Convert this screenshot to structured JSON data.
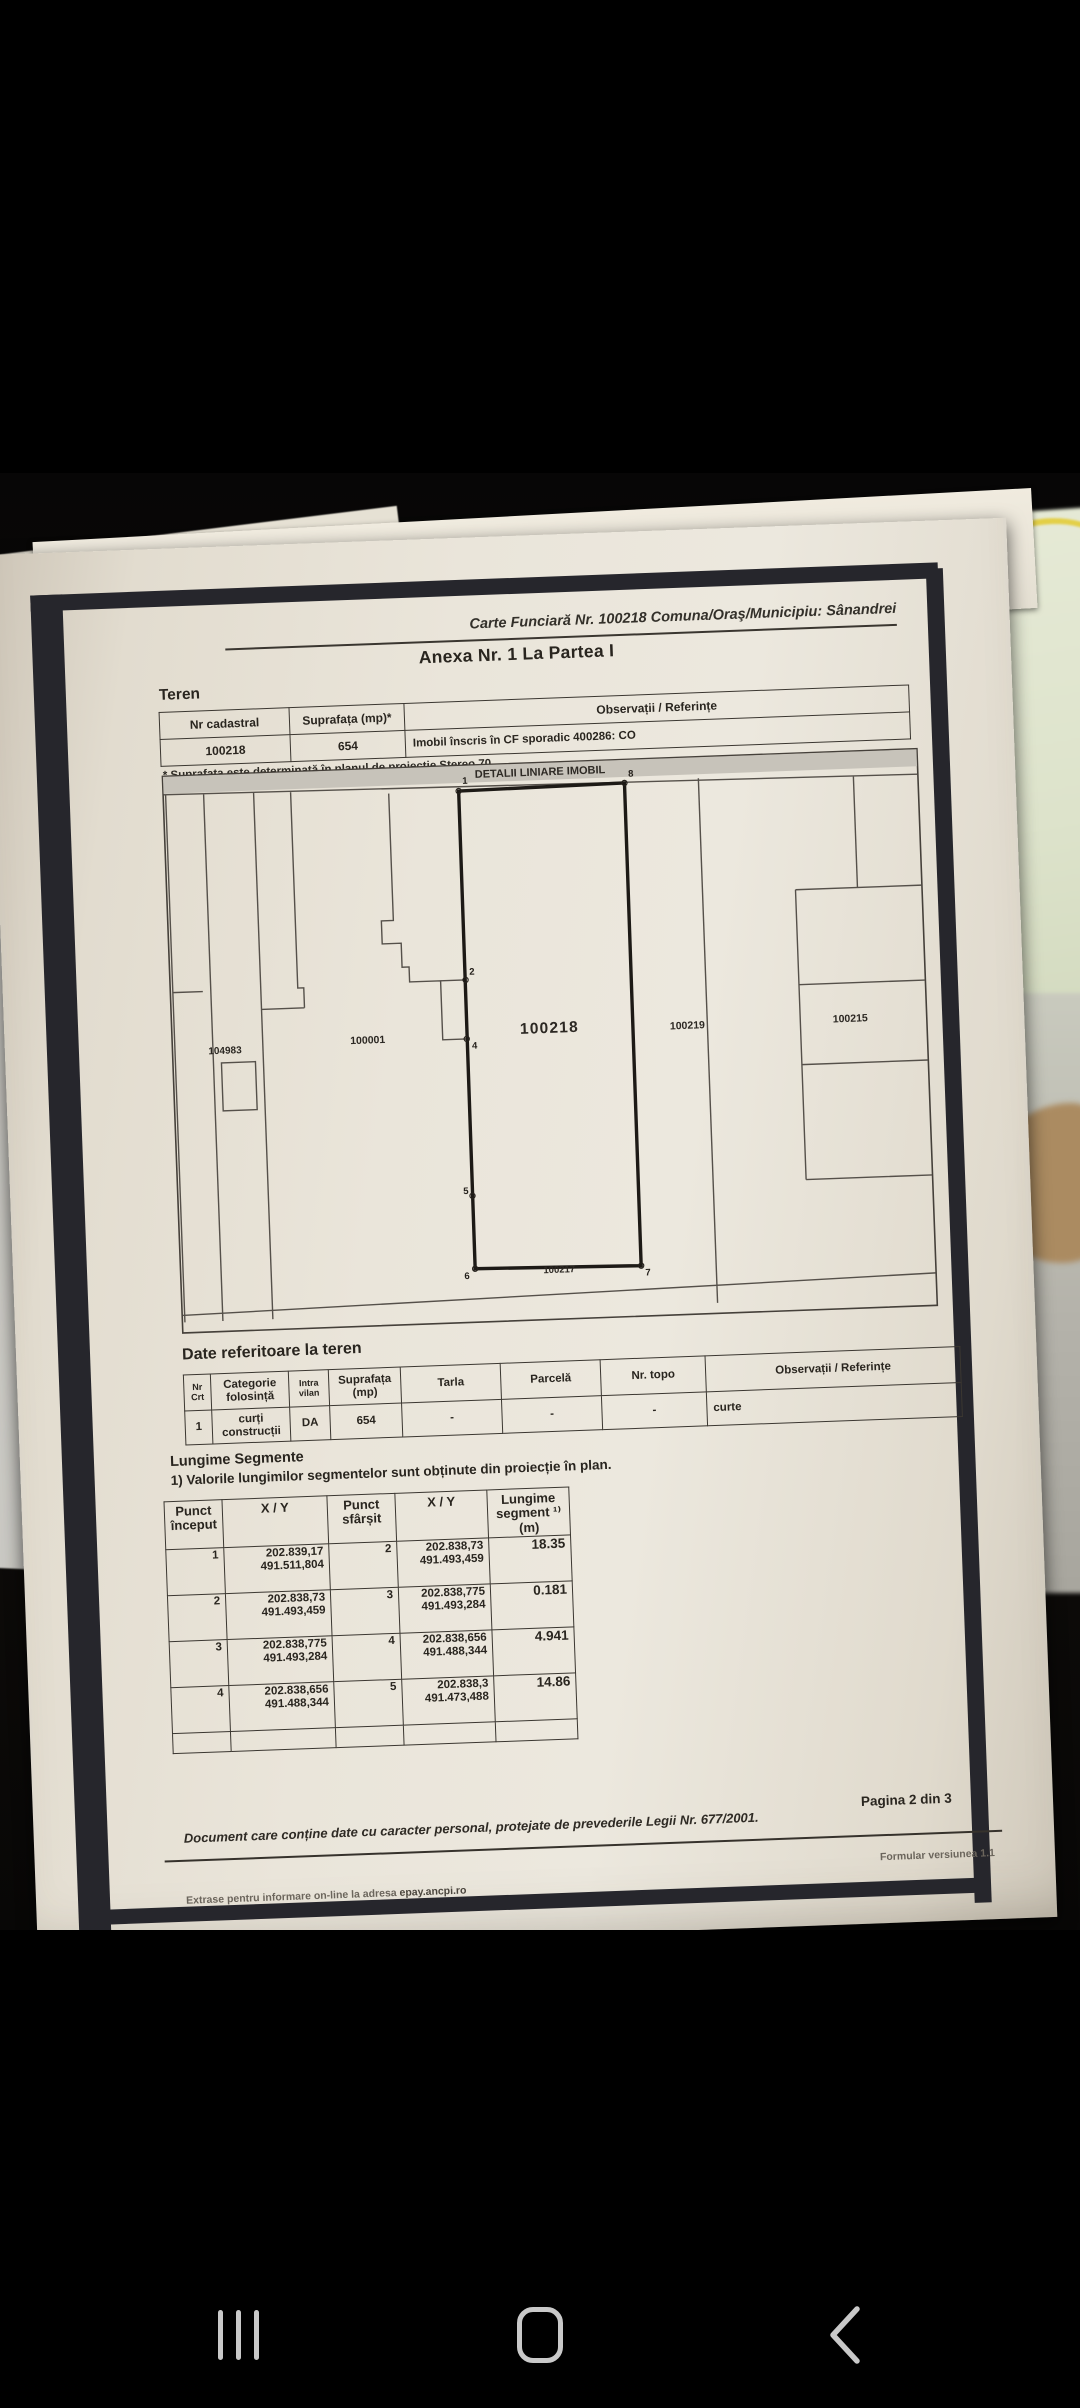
{
  "colors": {
    "paper": "#eae5da",
    "scan_border": "#26262c",
    "ink": "#29251f",
    "background_green": "#dde3cb",
    "background_yellow": "#e3cf46",
    "nav_icon": "#c9c9c9"
  },
  "nav": {
    "recents_icon": "recents-bars",
    "home_icon": "home-outline",
    "back_icon": "back-chevron"
  },
  "doc": {
    "ref_line": "Carte Funciară Nr. 100218 Comuna/Oraş/Municipiu: Sânandrei",
    "anexa_title": "Anexa Nr. 1 La Partea I",
    "teren_heading": "Teren",
    "teren_table": {
      "h_nr_cadastral": "Nr cadastral",
      "h_suprafata": "Suprafața (mp)*",
      "h_observatii": "Observații / Referințe",
      "nr_cadastral": "100218",
      "suprafata": "654",
      "observatii": "Imobil înscris în CF sporadic 400286: CO"
    },
    "footnote": "* Suprafața este determinată în planul de proiecție Stereo 70.",
    "plan": {
      "title": "DETALII LINIARE IMOBIL",
      "parcel_104983": "104983",
      "parcel_100001": "100001",
      "parcel_100218": "100218",
      "parcel_100219": "100219",
      "parcel_100215": "100215",
      "road_label": "100217",
      "pt1": "1",
      "pt2": "2",
      "pt4": "4",
      "pt5": "5",
      "pt6": "6",
      "pt7": "7",
      "pt8": "8"
    },
    "date_teren": {
      "heading": "Date referitoare la teren",
      "h_nr": "Nr Crt",
      "h_categorie": "Categorie folosință",
      "h_intravilan": "Intra vilan",
      "h_suprafata": "Suprafața (mp)",
      "h_tarla": "Tarla",
      "h_parcela": "Parcelă",
      "h_nrtopo": "Nr. topo",
      "h_obs": "Observații / Referințe",
      "r_nr": "1",
      "r_categorie": "curți construcții",
      "r_intravilan": "DA",
      "r_suprafata": "654",
      "r_tarla": "-",
      "r_parcela": "-",
      "r_nrtopo": "-",
      "r_obs": "curte"
    },
    "segments": {
      "heading": "Lungime Segmente",
      "note": "1) Valorile lungimilor segmentelor sunt obținute din proiecție în plan.",
      "h_p_start": "Punct început",
      "h_xy1": "X / Y",
      "h_p_end": "Punct sfârșit",
      "h_xy2": "X / Y",
      "h_len": "Lungime segment ¹⁾ (m)",
      "rows": [
        {
          "p1": "1",
          "x1": "202.839,17",
          "y1": "491.511,804",
          "p2": "2",
          "x2": "202.838,73",
          "y2": "491.493,459",
          "len": "18.35"
        },
        {
          "p1": "2",
          "x1": "202.838,73",
          "y1": "491.493,459",
          "p2": "3",
          "x2": "202.838,775",
          "y2": "491.493,284",
          "len": "0.181"
        },
        {
          "p1": "3",
          "x1": "202.838,775",
          "y1": "491.493,284",
          "p2": "4",
          "x2": "202.838,656",
          "y2": "491.488,344",
          "len": "4.941"
        },
        {
          "p1": "4",
          "x1": "202.838,656",
          "y1": "491.488,344",
          "p2": "5",
          "x2": "202.838,3",
          "y2": "491.473,488",
          "len": "14.86"
        }
      ]
    },
    "footer": {
      "privacy": "Document care conține date cu caracter personal, protejate de prevederile Legii Nr. 677/2001.",
      "page_info": "Pagina 2 din 3",
      "form_version": "Formular versiunea 1.1",
      "extras_prefix": "Extrase pentru informare on-line la adresa ",
      "extras_site": "epay.ancpi.ro"
    }
  }
}
